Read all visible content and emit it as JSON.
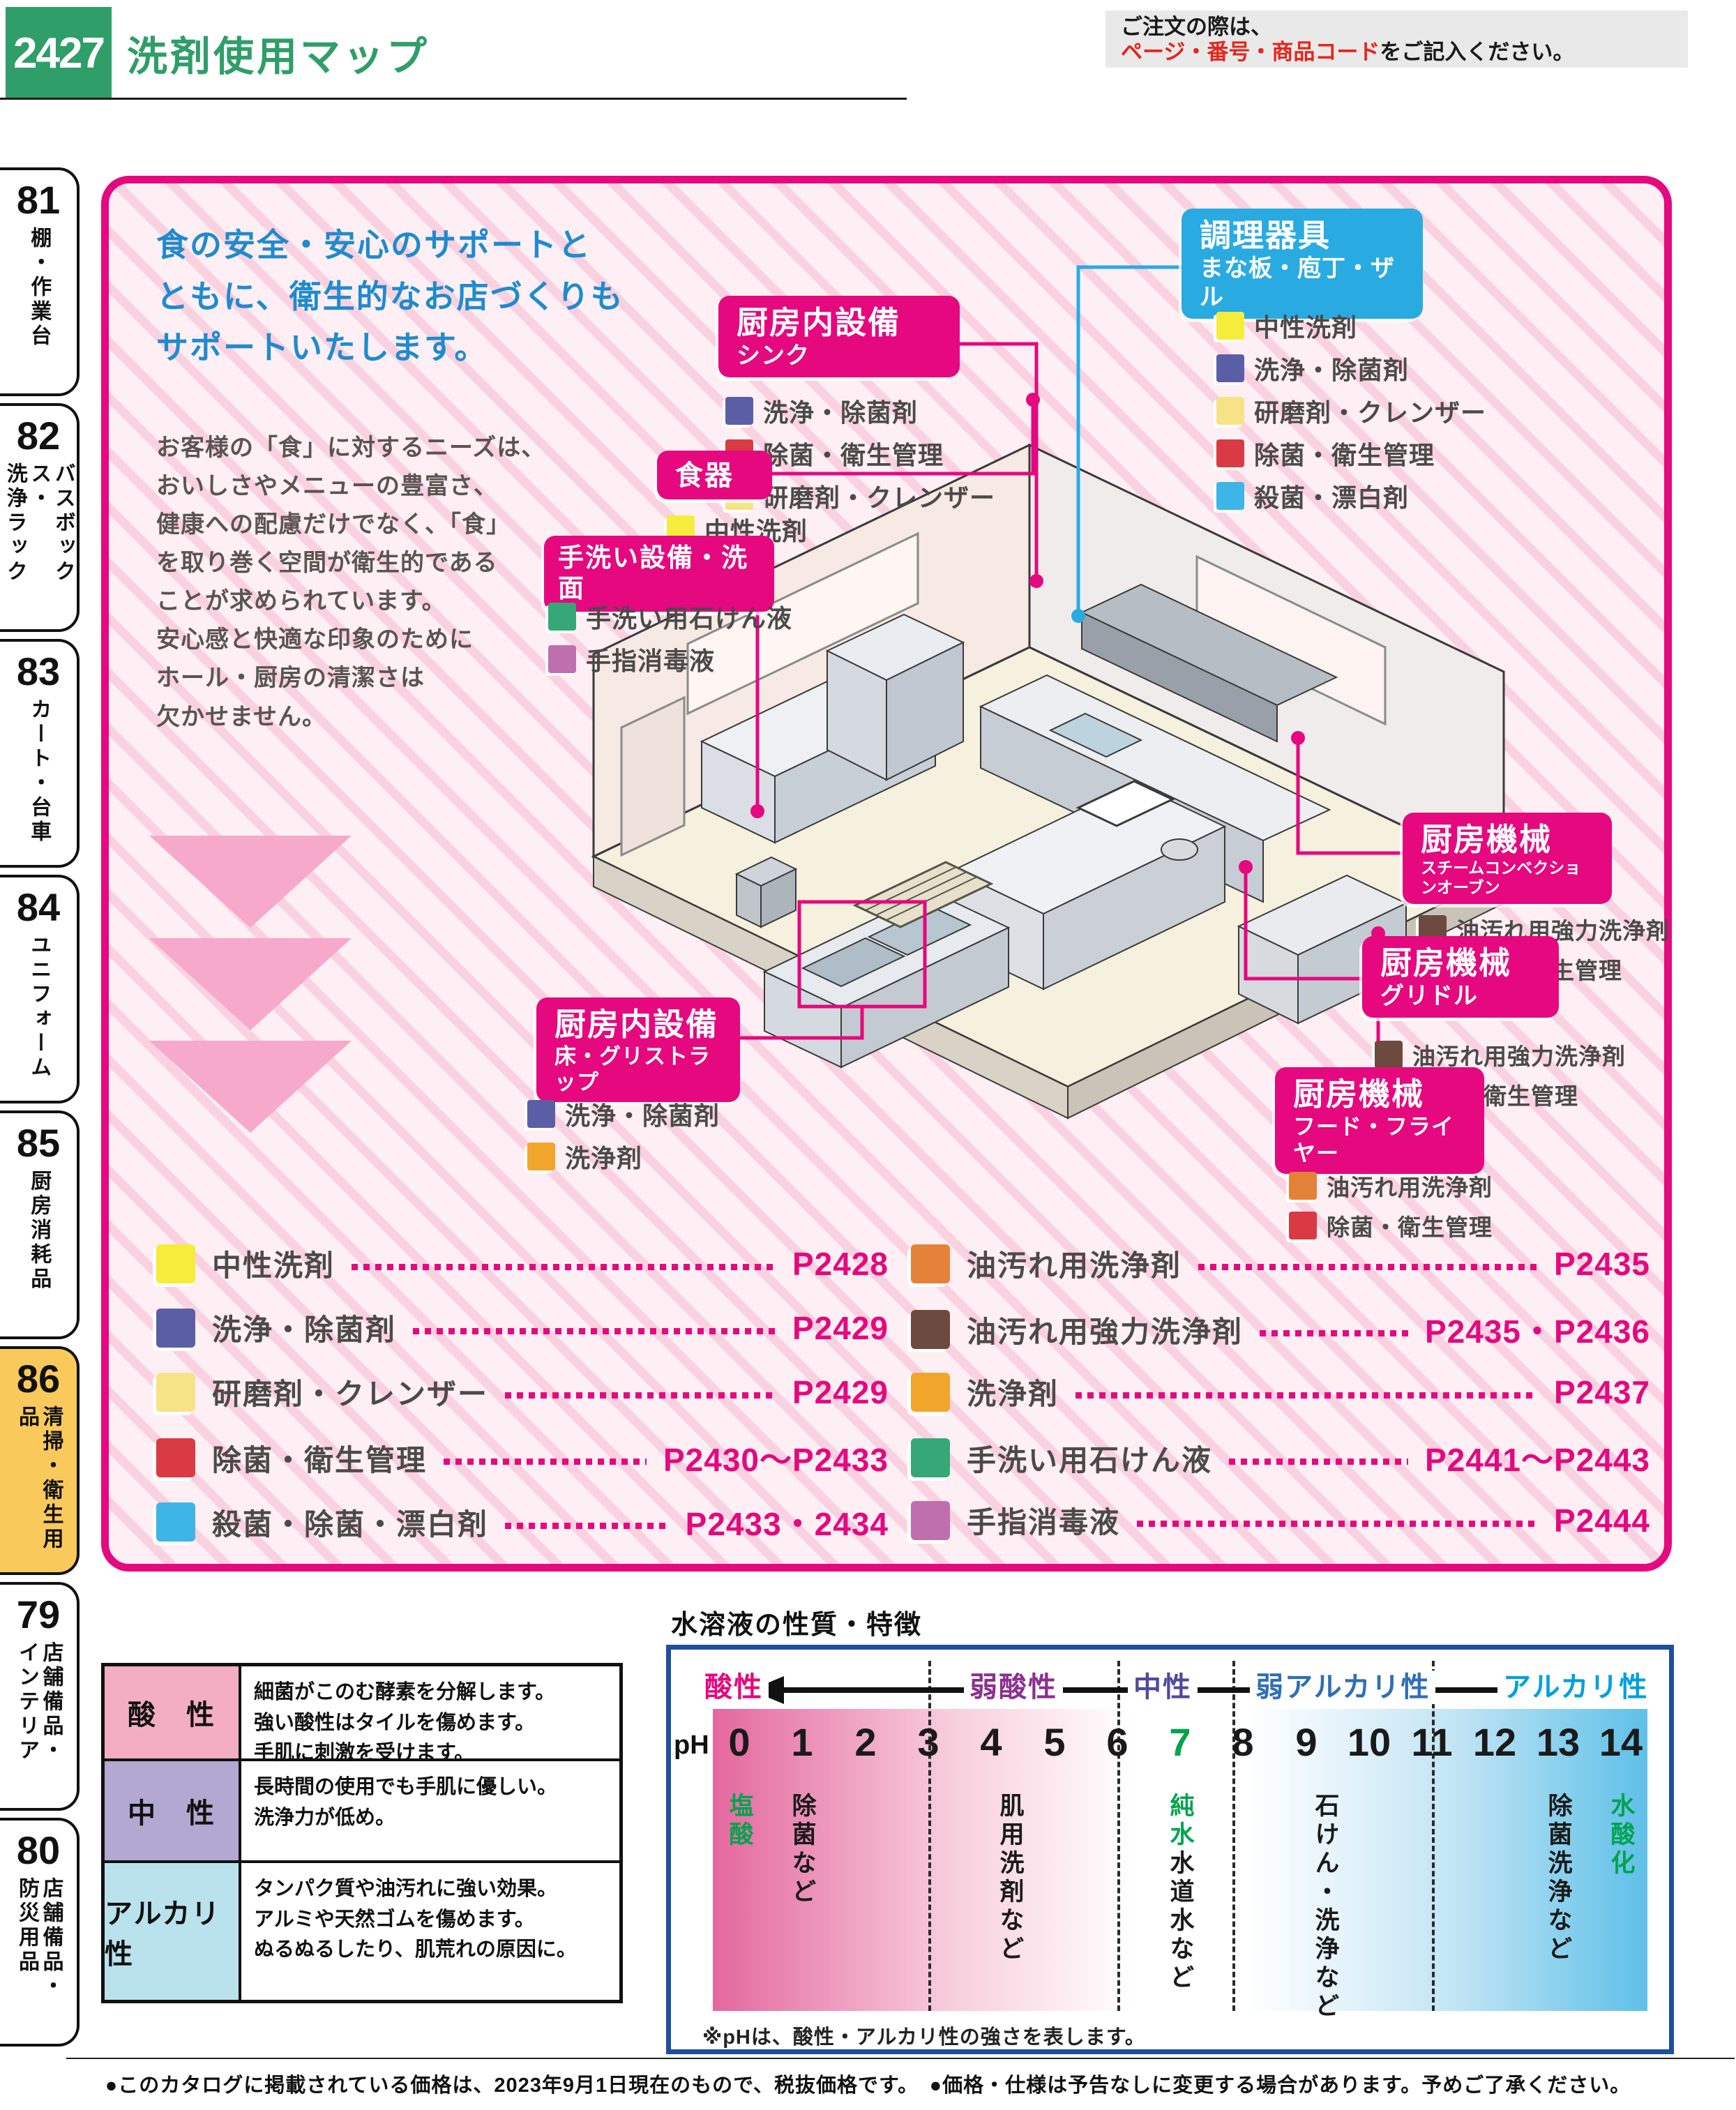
{
  "header": {
    "page_number": "2427",
    "title": "洗剤使用マップ",
    "note_line1": "ご注文の際は、",
    "note_em": "ページ・番号・商品コード",
    "note_line2": "をご記入ください。"
  },
  "sidebar": {
    "tabs": [
      {
        "num": "81",
        "label": "棚・作業台"
      },
      {
        "num": "82",
        "label": "バスボックス・\n洗浄ラック"
      },
      {
        "num": "83",
        "label": "カート・台車"
      },
      {
        "num": "84",
        "label": "ユニフォーム"
      },
      {
        "num": "85",
        "label": "厨房消耗品"
      },
      {
        "num": "86",
        "label": "清掃・衛生用品"
      },
      {
        "num": "79",
        "label": "店舗備品・\nインテリア"
      },
      {
        "num": "80",
        "label": "店舗備品・\n防災用品"
      }
    ]
  },
  "intro": {
    "headline": "食の安全・安心のサポートと\nともに、衛生的なお店づくりも\nサポートいたします。",
    "body": "お客様の「食」に対するニーズは、\nおいしさやメニューの豊富さ、\n健康への配慮だけでなく、「食」\nを取り巻く空間が衛生的である\nことが求められています。\n安心感と快適な印象のために\nホール・厨房の清潔さは\n欠かせません。"
  },
  "callouts": [
    {
      "title": "厨房内設備",
      "subtitle": "シンク",
      "accent": "#e5087f",
      "items": [
        {
          "color": "#5a5fa5",
          "label": "洗浄・除菌剤"
        },
        {
          "color": "#d93a43",
          "label": "除菌・衛生管理"
        },
        {
          "color": "#f6e388",
          "label": "研磨剤・クレンザー"
        }
      ]
    },
    {
      "title": "食器",
      "subtitle": "",
      "accent": "#e5087f",
      "items": [
        {
          "color": "#f5ec3c",
          "label": "中性洗剤"
        }
      ]
    },
    {
      "title": "手洗い設備・洗面",
      "subtitle": "",
      "accent": "#e5087f",
      "items": [
        {
          "color": "#36a878",
          "label": "手洗い用石けん液"
        },
        {
          "color": "#bf6fae",
          "label": "手指消毒液"
        }
      ]
    },
    {
      "title": "調理器具",
      "subtitle": "まな板・庖丁・ザル",
      "accent": "#29abe2",
      "items": [
        {
          "color": "#f5ec3c",
          "label": "中性洗剤"
        },
        {
          "color": "#5a5fa5",
          "label": "洗浄・除菌剤"
        },
        {
          "color": "#f6e388",
          "label": "研磨剤・クレンザー"
        },
        {
          "color": "#d93a43",
          "label": "除菌・衛生管理"
        },
        {
          "color": "#3db5e6",
          "label": "殺菌・漂白剤"
        }
      ]
    },
    {
      "title": "厨房機械",
      "subtitle": "スチームコンベクションオーブン",
      "accent": "#e5087f",
      "items": [
        {
          "color": "#6d4a40",
          "label": "油汚れ用強力洗浄剤"
        },
        {
          "color": "#d93a43",
          "label": "除菌・衛生管理"
        }
      ]
    },
    {
      "title": "厨房機械",
      "subtitle": "グリドル",
      "accent": "#e5087f",
      "items": [
        {
          "color": "#6d4a40",
          "label": "油汚れ用強力洗浄剤"
        },
        {
          "color": "#d93a43",
          "label": "除菌・衛生管理"
        }
      ]
    },
    {
      "title": "厨房機械",
      "subtitle": "フード・フライヤー",
      "accent": "#e5087f",
      "items": [
        {
          "color": "#e5823a",
          "label": "油汚れ用洗浄剤"
        },
        {
          "color": "#d93a43",
          "label": "除菌・衛生管理"
        }
      ]
    },
    {
      "title": "厨房内設備",
      "subtitle": "床・グリストラップ",
      "accent": "#e5087f",
      "items": [
        {
          "color": "#5a5fa5",
          "label": "洗浄・除菌剤"
        },
        {
          "color": "#f2a52b",
          "label": "洗浄剤"
        }
      ]
    }
  ],
  "legend": {
    "left": [
      {
        "color": "#f5ec3c",
        "label": "中性洗剤",
        "page": "P2428"
      },
      {
        "color": "#5a5fa5",
        "label": "洗浄・除菌剤",
        "page": "P2429"
      },
      {
        "color": "#f6e388",
        "label": "研磨剤・クレンザー",
        "page": "P2429"
      },
      {
        "color": "#d93a43",
        "label": "除菌・衛生管理",
        "page": "P2430〜P2433"
      },
      {
        "color": "#3db5e6",
        "label": "殺菌・除菌・漂白剤",
        "page": "P2433・2434"
      }
    ],
    "right": [
      {
        "color": "#e5823a",
        "label": "油汚れ用洗浄剤",
        "page": "P2435"
      },
      {
        "color": "#6d4a40",
        "label": "油汚れ用強力洗浄剤",
        "page": "P2435・P2436"
      },
      {
        "color": "#f2a52b",
        "label": "洗浄剤",
        "page": "P2437"
      },
      {
        "color": "#36a878",
        "label": "手洗い用石けん液",
        "page": "P2441〜P2443"
      },
      {
        "color": "#bf6fae",
        "label": "手指消毒液",
        "page": "P2444"
      }
    ]
  },
  "ph_table": {
    "rows": [
      {
        "name": "酸　性",
        "color": "#f4aec4",
        "desc": "細菌がこのむ酵素を分解します。\n強い酸性はタイルを傷めます。\n手肌に刺激を受けます。"
      },
      {
        "name": "中　性",
        "color": "#b2a8d2",
        "desc": "長時間の使用でも手肌に優しい。\n洗浄力が低め。"
      },
      {
        "name": "アルカリ性",
        "color": "#b9e2ec",
        "desc": "タンパク質や油汚れに強い効果。\nアルミや天然ゴムを傷めます。\nぬるぬるしたり、肌荒れの原因に。"
      }
    ]
  },
  "ph_chart": {
    "title": "水溶液の性質・特徴",
    "ph_label": "pH",
    "scale": [
      {
        "text": "酸性",
        "color": "#e5087f"
      },
      {
        "text": "弱酸性",
        "color": "#8b2f8f"
      },
      {
        "text": "中性",
        "color": "#4f4a9c"
      },
      {
        "text": "弱アルカリ性",
        "color": "#2f6eb6"
      },
      {
        "text": "アルカリ性",
        "color": "#00a0dd"
      }
    ],
    "numbers": [
      "0",
      "1",
      "2",
      "3",
      "4",
      "5",
      "6",
      "7",
      "8",
      "9",
      "10",
      "11",
      "12",
      "13",
      "14"
    ],
    "neutral_color": "#00a34e",
    "annotations": [
      {
        "parts": [
          {
            "text": "塩酸",
            "color": "#00a34e"
          }
        ]
      },
      {
        "parts": [
          {
            "text": "除菌など",
            "color": "#1a1a1a"
          }
        ]
      },
      {
        "parts": [
          {
            "text": "肌用洗剤など",
            "color": "#1a1a1a"
          }
        ]
      },
      {
        "parts": [
          {
            "text": "純水",
            "color": "#00a34e"
          },
          {
            "text": "水道水など",
            "color": "#1a1a1a"
          }
        ]
      },
      {
        "parts": [
          {
            "text": "石けん・洗浄など",
            "color": "#1a1a1a"
          }
        ]
      },
      {
        "parts": [
          {
            "text": "除菌洗浄など",
            "color": "#1a1a1a"
          }
        ]
      },
      {
        "parts": [
          {
            "text": "水酸化",
            "color": "#00a34e"
          }
        ]
      }
    ],
    "footnote": "※pHは、酸性・アルカリ性の強さを表します。"
  },
  "footer": {
    "note": "●このカタログに掲載されている価格は、2023年9月1日現在のもので、税抜価格です。　●価格・仕様は予告なしに変更する場合があります。予めご了承ください。"
  }
}
